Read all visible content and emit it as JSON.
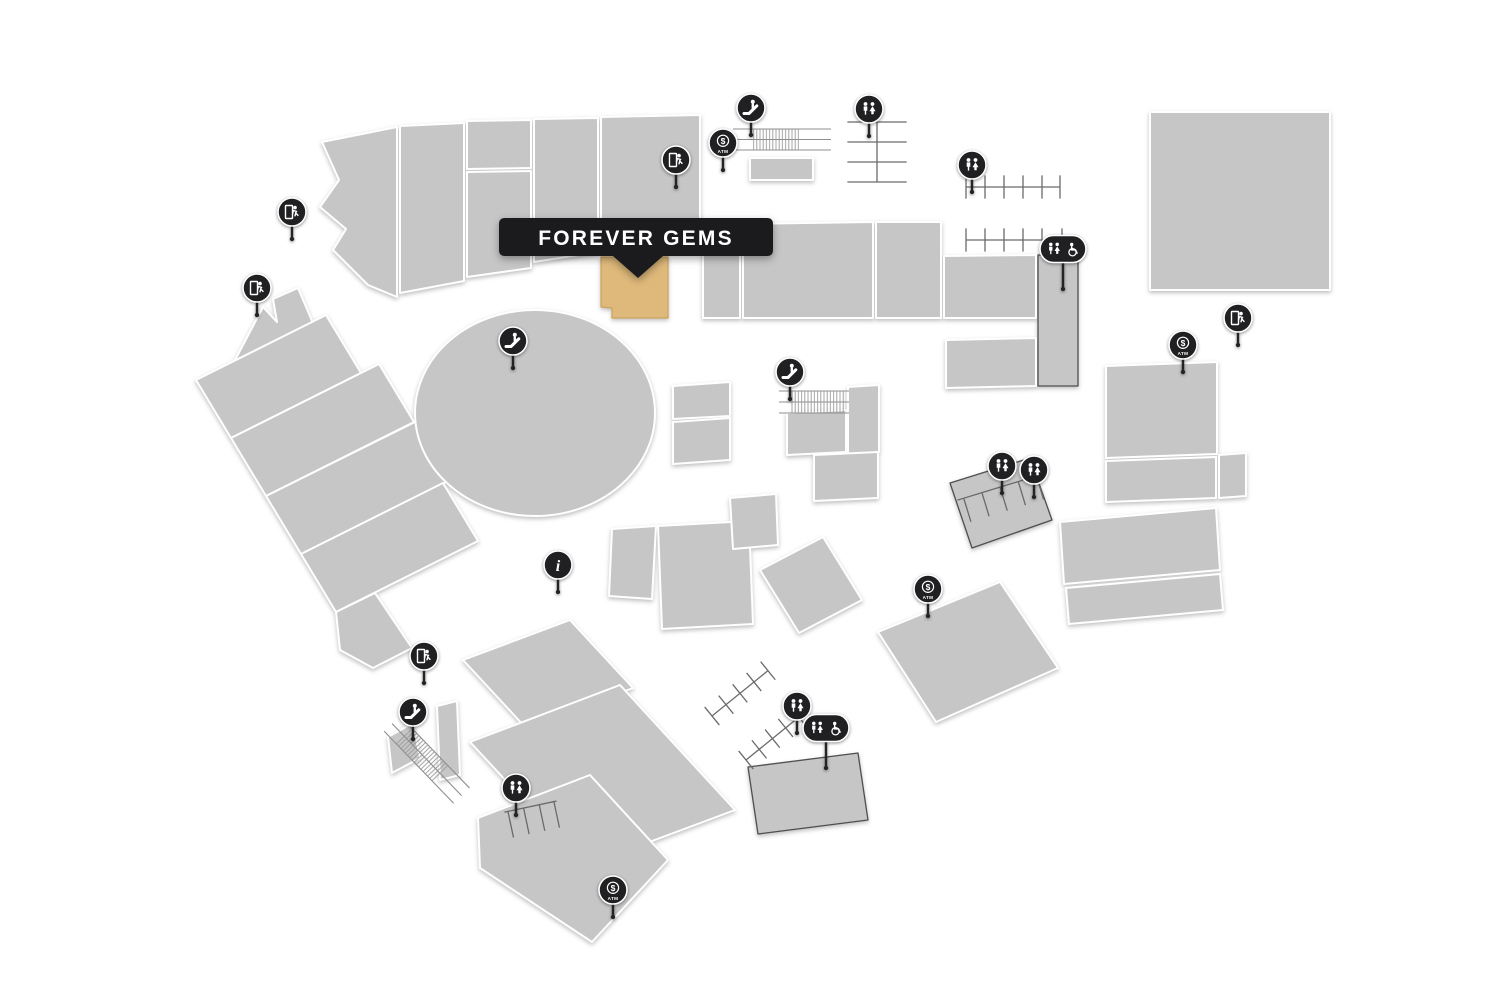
{
  "map": {
    "tooltip": {
      "label": "FOREVER GEMS"
    },
    "icon_labels": {
      "atm": "ATM"
    },
    "colors": {
      "background": "#ffffff",
      "store_fill": "#c6c6c6",
      "store_stroke": "#ffffff",
      "highlight_fill": "#dfb97b",
      "highlight_stroke": "#cda25d",
      "tooltip_bg": "#1b1b1d",
      "tooltip_text": "#ffffff",
      "icon_bg": "#202022",
      "icon_glyph": "#ffffff",
      "structure_stroke": "#6a6a6c"
    },
    "icons": [
      {
        "type": "emergency-exit",
        "x": 292,
        "y": 212
      },
      {
        "type": "emergency-exit",
        "x": 257,
        "y": 288
      },
      {
        "type": "escalator",
        "x": 513,
        "y": 341
      },
      {
        "type": "emergency-exit",
        "x": 676,
        "y": 160
      },
      {
        "type": "escalator",
        "x": 751,
        "y": 108
      },
      {
        "type": "atm",
        "x": 723,
        "y": 143
      },
      {
        "type": "restroom",
        "x": 869,
        "y": 109
      },
      {
        "type": "restroom",
        "x": 972,
        "y": 165
      },
      {
        "type": "restroom-accessible",
        "x": 1063,
        "y": 249
      },
      {
        "type": "atm",
        "x": 1183,
        "y": 345
      },
      {
        "type": "emergency-exit",
        "x": 1238,
        "y": 318
      },
      {
        "type": "escalator",
        "x": 790,
        "y": 372
      },
      {
        "type": "info",
        "x": 558,
        "y": 565
      },
      {
        "type": "emergency-exit",
        "x": 424,
        "y": 656
      },
      {
        "type": "escalator",
        "x": 413,
        "y": 712
      },
      {
        "type": "restroom",
        "x": 516,
        "y": 788
      },
      {
        "type": "atm",
        "x": 613,
        "y": 890
      },
      {
        "type": "restroom",
        "x": 797,
        "y": 706
      },
      {
        "type": "restroom-accessible",
        "x": 826,
        "y": 728
      },
      {
        "type": "restroom",
        "x": 1002,
        "y": 466
      },
      {
        "type": "restroom",
        "x": 1034,
        "y": 470
      },
      {
        "type": "atm",
        "x": 928,
        "y": 589
      }
    ]
  }
}
